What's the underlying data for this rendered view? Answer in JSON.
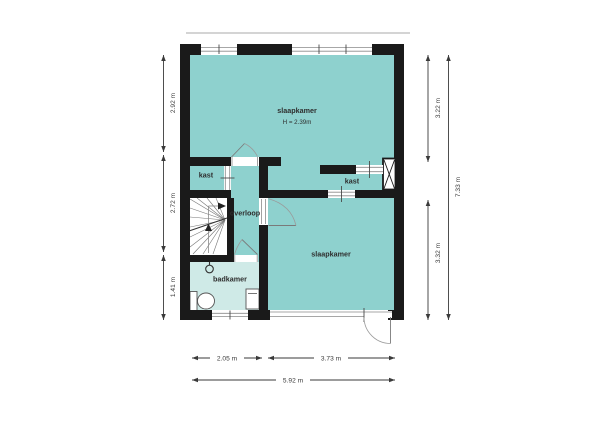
{
  "rooms": {
    "bedroom_top": {
      "label": "slaapkamer",
      "height_note": "H = 2.39m"
    },
    "bedroom_bottom": {
      "label": "slaapkamer"
    },
    "closet_left": {
      "label": "kast"
    },
    "closet_right": {
      "label": "kast"
    },
    "landing": {
      "label": "overloop"
    },
    "bathroom": {
      "label": "badkamer"
    }
  },
  "dimensions": {
    "left_top": "2.92 m",
    "left_middle": "2.72 m",
    "left_bottom": "1.41 m",
    "right_top": "3.22 m",
    "right_bottom": "3.32 m",
    "right_total": "7.33 m",
    "bottom_left": "2.05 m",
    "bottom_right": "3.73 m",
    "bottom_total": "5.92 m"
  },
  "colors": {
    "room_fill": "#8ed1ce",
    "bathroom_fill": "#cfeae7",
    "wall": "#1a1a1a",
    "dim": "#3a3a3a"
  }
}
